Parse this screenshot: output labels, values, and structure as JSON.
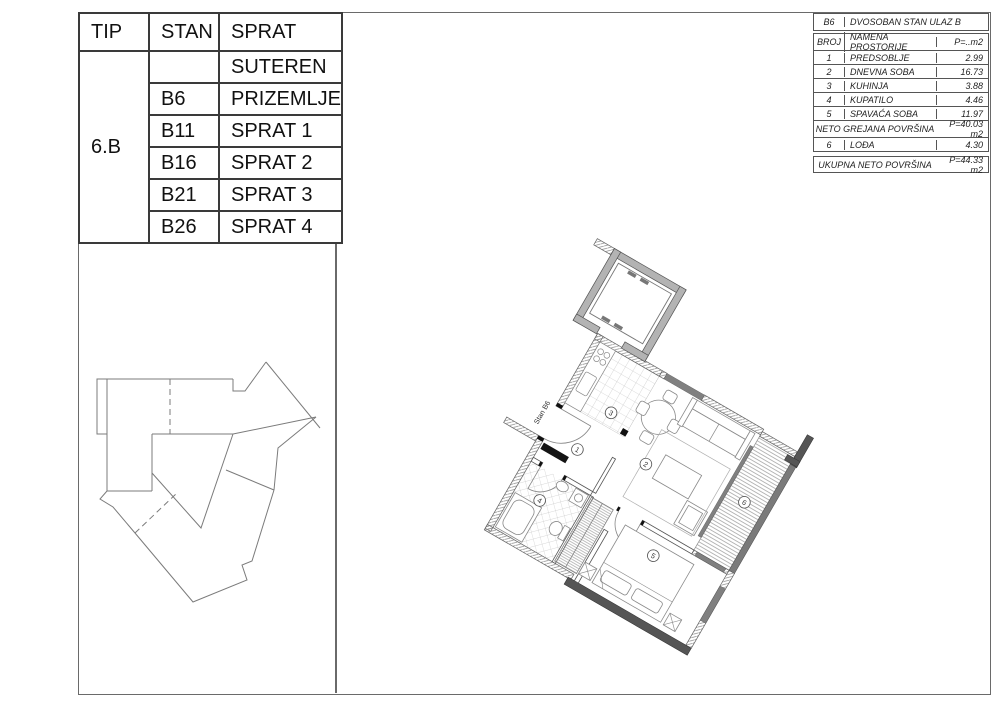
{
  "left_table": {
    "headers": {
      "tip": "TIP",
      "stan": "STAN",
      "sprat": "SPRAT"
    },
    "tip_value": "6.B",
    "rows": [
      {
        "stan": "",
        "sprat": "SUTEREN"
      },
      {
        "stan": "B6",
        "sprat": "PRIZEMLJE"
      },
      {
        "stan": "B11",
        "sprat": "SPRAT 1"
      },
      {
        "stan": "B16",
        "sprat": "SPRAT 2"
      },
      {
        "stan": "B21",
        "sprat": "SPRAT 3"
      },
      {
        "stan": "B26",
        "sprat": "SPRAT 4"
      }
    ]
  },
  "info_table": {
    "unit": "B6",
    "title": "DVOSOBAN STAN ULAZ B",
    "col_broj": "BROJ",
    "col_namena": "NAMENA PROSTORIJE",
    "col_area": "P=..m2",
    "rooms": [
      {
        "broj": "1",
        "name": "PREDSOBLJE",
        "area": "2.99"
      },
      {
        "broj": "2",
        "name": "DNEVNA SOBA",
        "area": "16.73"
      },
      {
        "broj": "3",
        "name": "KUHINJA",
        "area": "3.88"
      },
      {
        "broj": "4",
        "name": "KUPATILO",
        "area": "4.46"
      },
      {
        "broj": "5",
        "name": "SPAVAĆA SOBA",
        "area": "11.97"
      }
    ],
    "neto_label": "NETO GREJANA POVRŠINA",
    "neto_value": "P=40.03 m2",
    "loda_broj": "6",
    "loda_name": "LOĐA",
    "loda_area": "4.30",
    "ukupna_label": "UKUPNA NETO POVRŠINA",
    "ukupna_value": "P=44.33 m2"
  },
  "plan": {
    "unit_label": "Stan B6",
    "room_numbers": [
      "1",
      "2",
      "3",
      "4",
      "5",
      "6"
    ],
    "colors": {
      "wall_dark": "#555555",
      "window_gray": "#808080",
      "shaft_gray": "#b3b3b3"
    }
  }
}
